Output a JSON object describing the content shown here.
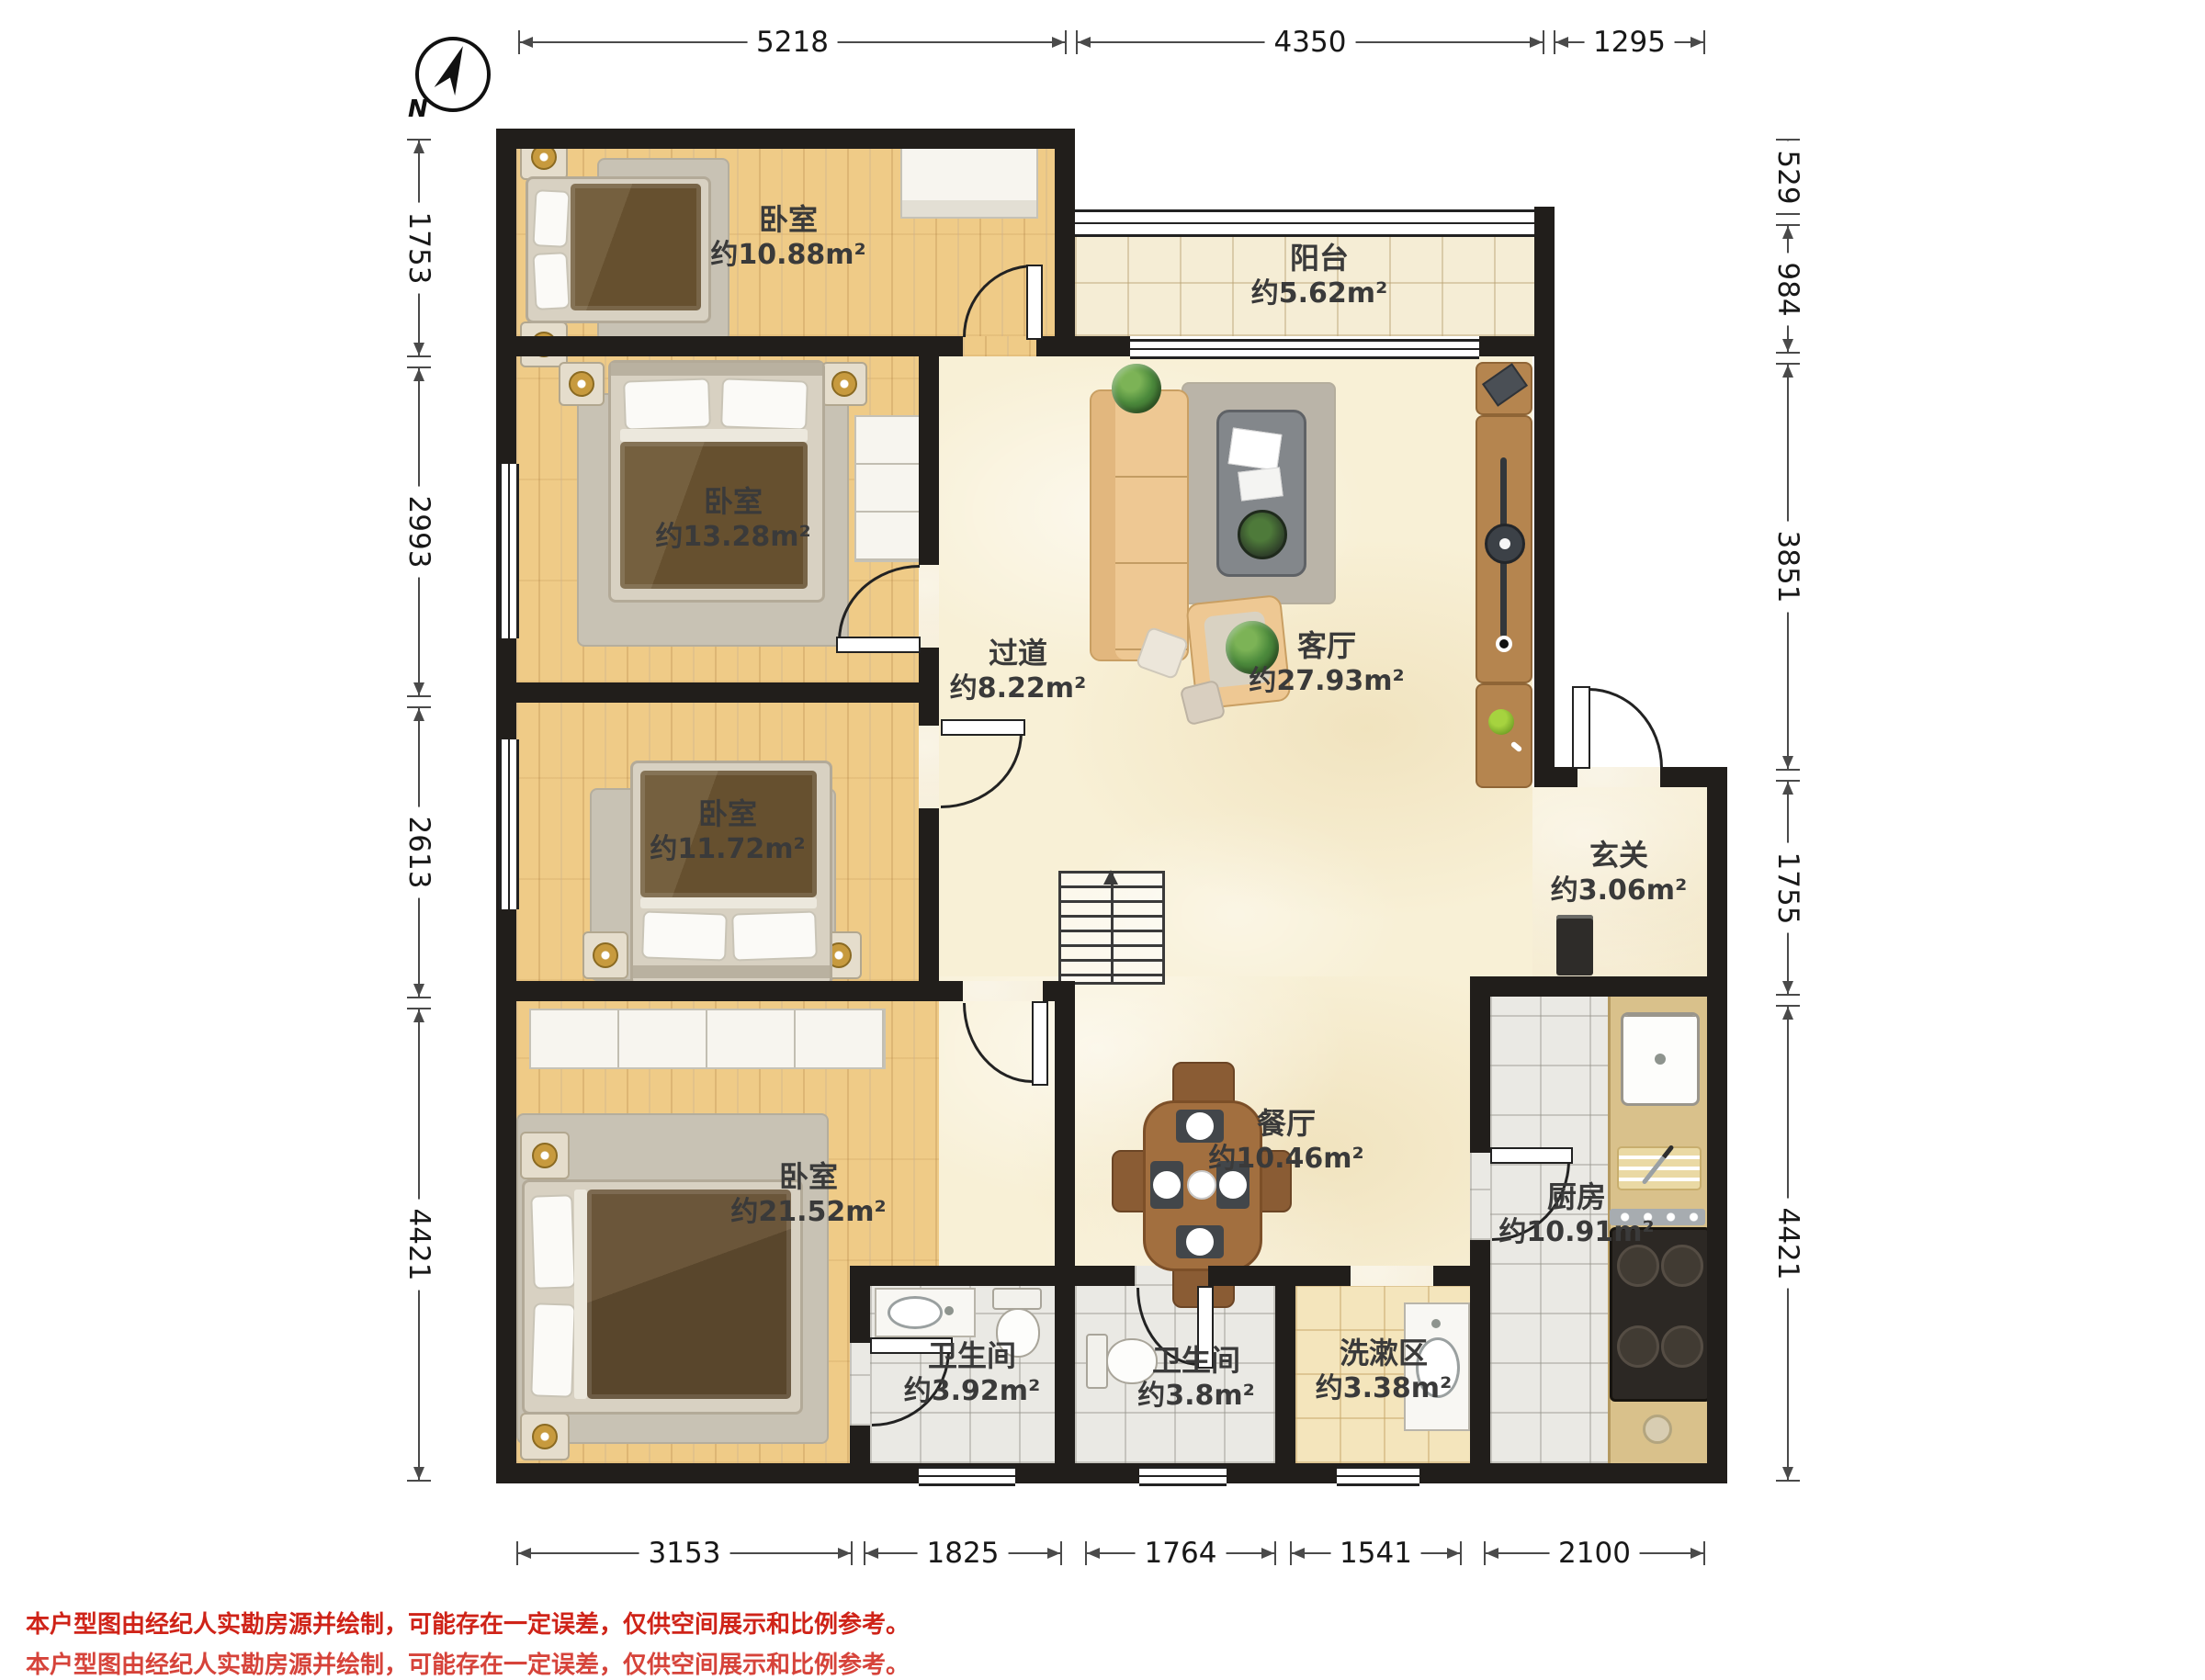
{
  "compass": {
    "north_label": "N"
  },
  "rooms": {
    "bedroom1": {
      "name": "卧室",
      "area": "约10.88m²"
    },
    "balcony": {
      "name": "阳台",
      "area": "约5.62m²"
    },
    "bedroom2": {
      "name": "卧室",
      "area": "约13.28m²"
    },
    "hallway": {
      "name": "过道",
      "area": "约8.22m²"
    },
    "living": {
      "name": "客厅",
      "area": "约27.93m²"
    },
    "bedroom3": {
      "name": "卧室",
      "area": "约11.72m²"
    },
    "entry": {
      "name": "玄关",
      "area": "约3.06m²"
    },
    "bedroom4": {
      "name": "卧室",
      "area": "约21.52m²"
    },
    "dining": {
      "name": "餐厅",
      "area": "约10.46m²"
    },
    "kitchen": {
      "name": "厨房",
      "area": "约10.91m²"
    },
    "bath1": {
      "name": "卫生间",
      "area": "约3.92m²"
    },
    "bath2": {
      "name": "卫生间",
      "area": "约3.8m²"
    },
    "washing": {
      "name": "洗漱区",
      "area": "约3.38m²"
    }
  },
  "dimensions": {
    "top": [
      "5218",
      "4350",
      "1295"
    ],
    "left": [
      "1753",
      "2993",
      "2613",
      "4421"
    ],
    "right": [
      "529",
      "984",
      "3851",
      "1755",
      "4421"
    ],
    "bottom": [
      "3153",
      "1825",
      "1764",
      "1541",
      "2100"
    ]
  },
  "disclaimer": "本户型图由经纪人实勘房源并绘制，可能存在一定误差，仅供空间展示和比例参考。",
  "colors": {
    "wall": "#211e1b",
    "wood_floor": "#efcb87",
    "marble_floor": "#f8f0d6",
    "gray_tile": "#eae9e4",
    "balcony_tile": "#f5edd5",
    "washing_tile": "#f4e5bc",
    "disclaimer_red": "#cf2318"
  }
}
